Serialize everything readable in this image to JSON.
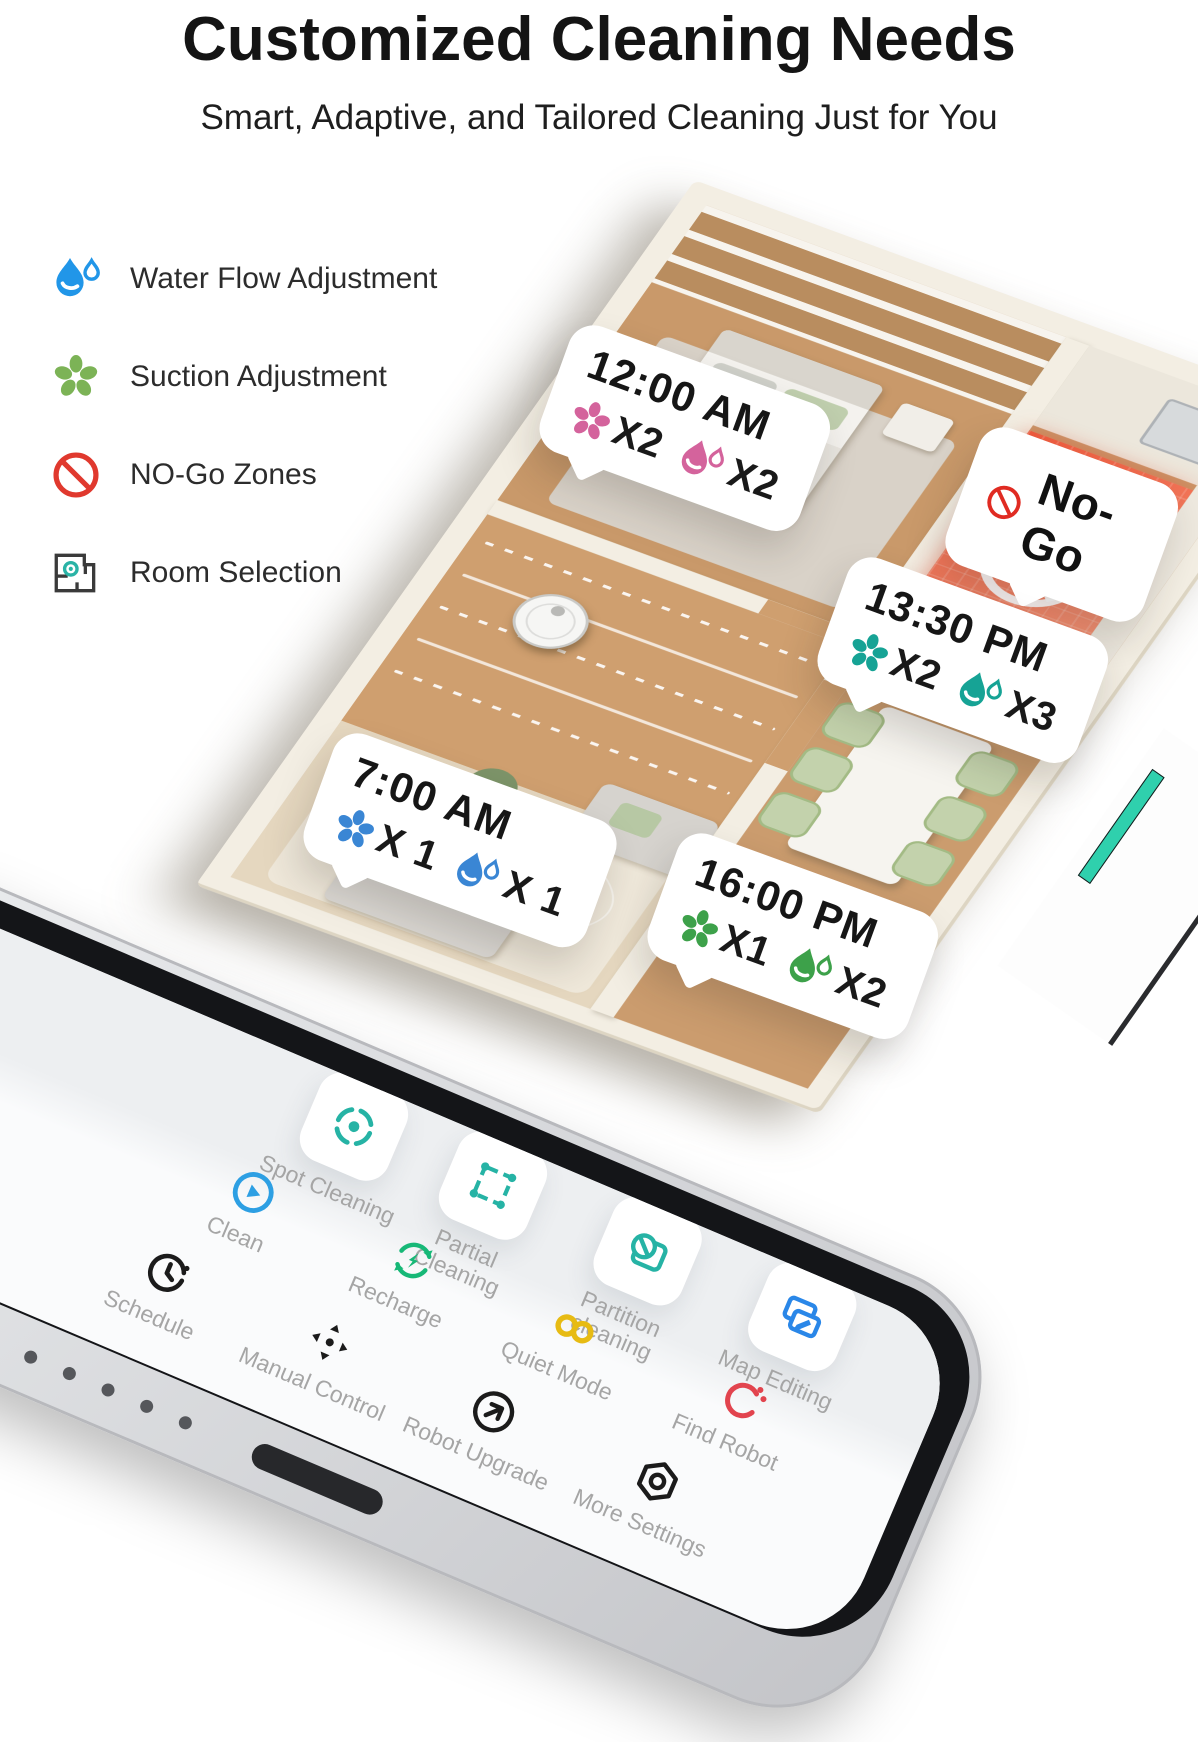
{
  "header": {
    "title": "Customized Cleaning Needs",
    "subtitle": "Smart, Adaptive, and Tailored Cleaning Just for You"
  },
  "legend": {
    "items": [
      {
        "icon": "water-drop-icon",
        "label": "Water Flow Adjustment",
        "color": "#2196e8"
      },
      {
        "icon": "suction-fan-icon",
        "label": "Suction Adjustment",
        "color": "#7cb356"
      },
      {
        "icon": "no-go-icon",
        "label": "NO-Go Zones",
        "color": "#e0392e"
      },
      {
        "icon": "room-selection-icon",
        "label": "Room Selection",
        "color": "#3a3a3a"
      }
    ]
  },
  "floorplan": {
    "nogo_callout": {
      "label": "No-Go",
      "accent": "#e02b22"
    },
    "callouts": [
      {
        "room": "bedroom",
        "time": "12:00 AM",
        "suction_count": "X2",
        "water_count": "X2",
        "accent": "#d4639c"
      },
      {
        "room": "dining-room",
        "time": "13:30 PM",
        "suction_count": "X2",
        "water_count": "X3",
        "accent": "#16a395"
      },
      {
        "room": "living-room",
        "time": "7:00 AM",
        "suction_count": "X 1",
        "water_count": "X 1",
        "accent": "#3a86d4"
      },
      {
        "room": "hallway",
        "time": "16:00 PM",
        "suction_count": "X1",
        "water_count": "X2",
        "accent": "#3da14a"
      }
    ]
  },
  "phone": {
    "apps": [
      {
        "label": "Spot Cleaning",
        "icon": "target-icon",
        "color": "#26b3a5"
      },
      {
        "label": "Partial\nCleaning",
        "icon": "marquee-icon",
        "color": "#26b3a5"
      },
      {
        "label": "Partition\ncleaning",
        "icon": "zone-block-icon",
        "color": "#26b3a5"
      },
      {
        "label": "Map Editing",
        "icon": "map-edit-icon",
        "color": "#2a87e8"
      },
      {
        "label": "Clean",
        "icon": "play-icon",
        "color": "#2d9fe3"
      },
      {
        "label": "Recharge",
        "icon": "recharge-icon",
        "color": "#17b877"
      },
      {
        "label": "Quiet Mode",
        "icon": "quiet-icon",
        "color": "#e7bb13"
      },
      {
        "label": "Find Robot",
        "icon": "find-robot-icon",
        "color": "#e2444e"
      },
      {
        "label": "Schedule",
        "icon": "clock-icon",
        "color": "#1b1b1b"
      },
      {
        "label": "Manual Control",
        "icon": "move-icon",
        "color": "#1b1b1b"
      },
      {
        "label": "Robot Upgrade",
        "icon": "upgrade-icon",
        "color": "#1b1b1b"
      },
      {
        "label": "More Settings",
        "icon": "settings-icon",
        "color": "#1b1b1b"
      }
    ]
  }
}
